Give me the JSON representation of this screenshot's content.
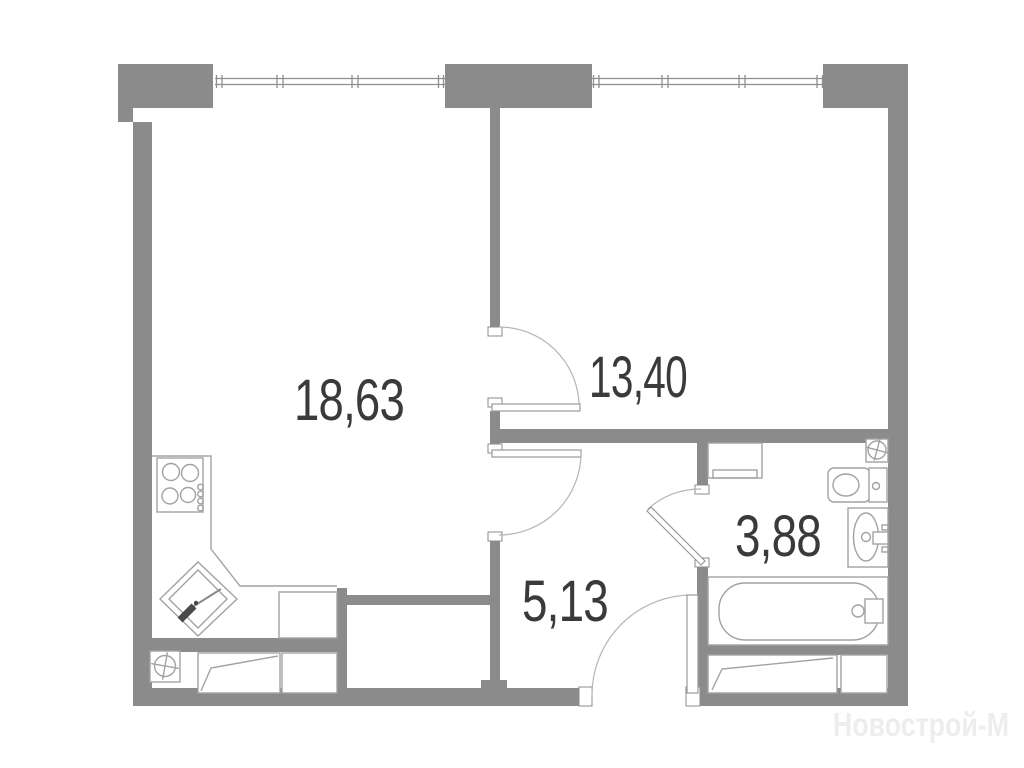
{
  "plan": {
    "title": "apartment-floor-plan",
    "rooms": [
      {
        "name": "living-room-kitchen",
        "area": "18,63"
      },
      {
        "name": "bedroom",
        "area": "13,40"
      },
      {
        "name": "bathroom",
        "area": "3,88"
      },
      {
        "name": "hallway",
        "area": "5,13"
      }
    ],
    "watermark": "Новострой-М",
    "colors": {
      "wall": "#8b8b8b",
      "fixture": "#a2a2a2",
      "arc": "#b5b5b5",
      "label": "#3a3a3a",
      "wm": "#ededed",
      "bg": "#ffffff"
    },
    "fixtures": [
      "stove-icon",
      "kitchen-sink-icon",
      "kitchen-counter",
      "washing-machine-icon",
      "vent-shaft-icon",
      "toilet-icon",
      "washbasin-icon",
      "bathtub-icon",
      "bed-icon"
    ]
  }
}
